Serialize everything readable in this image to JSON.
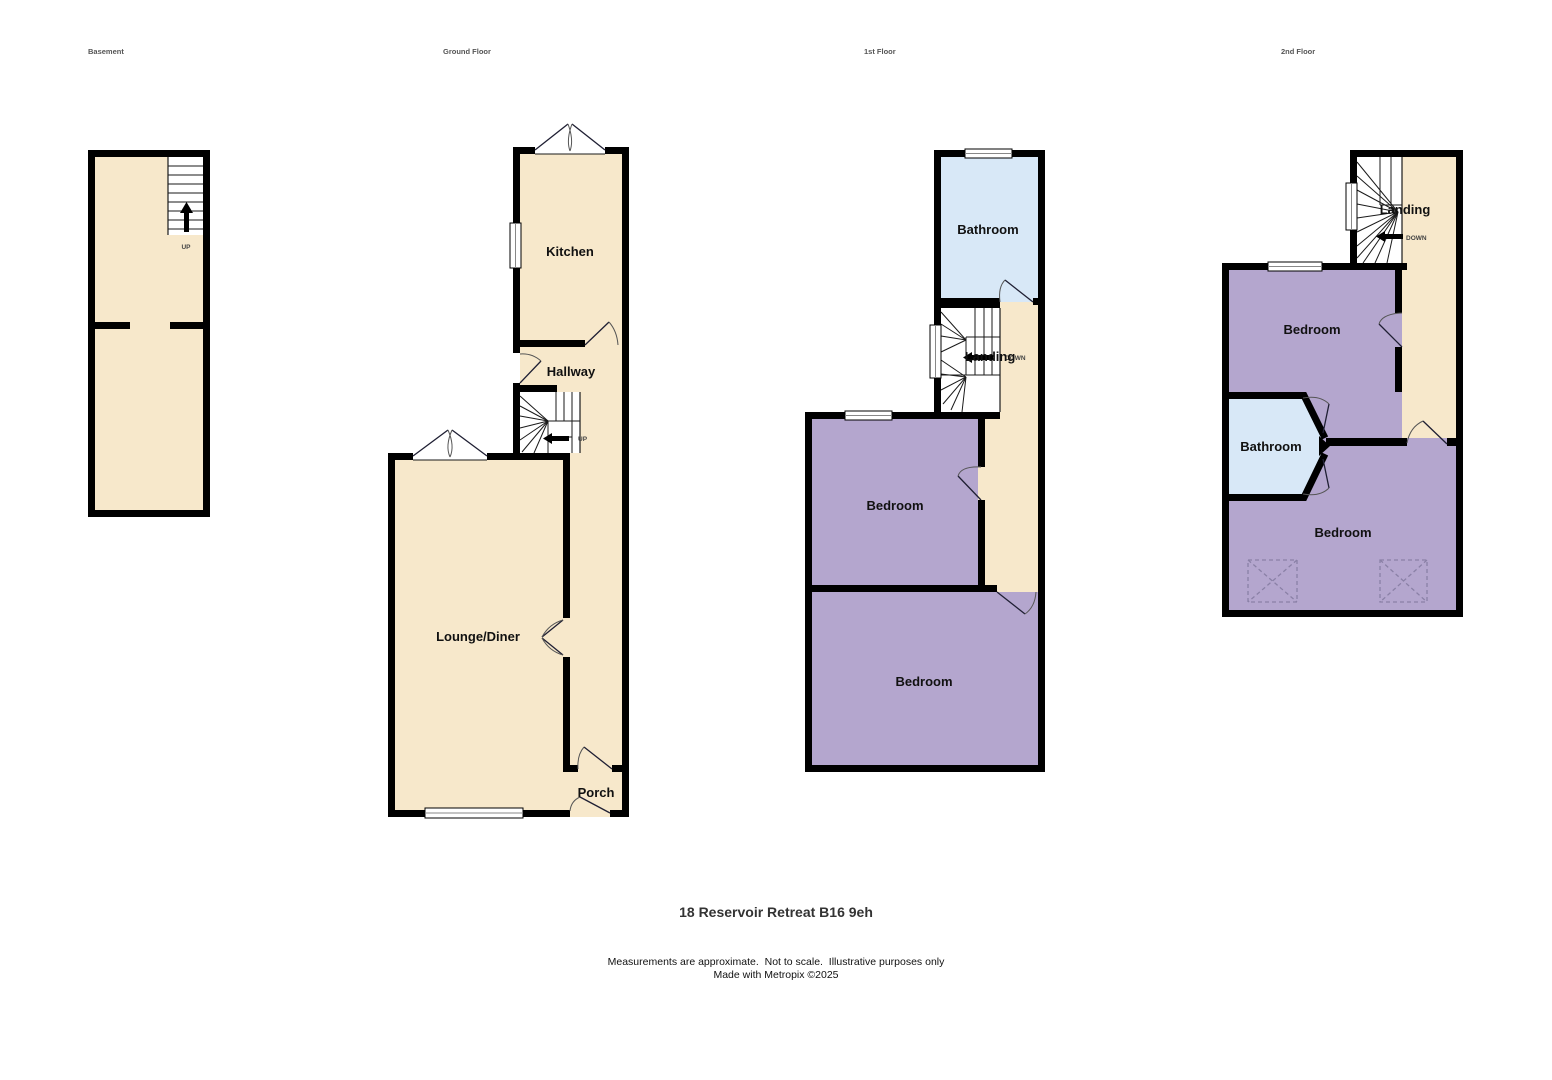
{
  "colors": {
    "cream": "#F7E8CB",
    "purple": "#B4A6CE",
    "blue": "#D8E8F7",
    "wall": "#000000",
    "arc": "#555555",
    "dashed_box": "#8A80A6",
    "label": "#111111",
    "floor_label": "#555555",
    "title_color": "#333333",
    "disclaimer": "#111111"
  },
  "floors": {
    "basement": {
      "label": "Basement",
      "stairs_direction": "UP"
    },
    "ground": {
      "label": "Ground Floor",
      "rooms": {
        "kitchen": "Kitchen",
        "hallway": "Hallway",
        "lounge": "Lounge/Diner",
        "porch": "Porch"
      },
      "stairs_direction": "UP"
    },
    "first": {
      "label": "1st Floor",
      "rooms": {
        "bathroom": "Bathroom",
        "landing": "Landing",
        "bedroom_front": "Bedroom",
        "bedroom_back": "Bedroom"
      },
      "stairs_direction": "DOWN"
    },
    "second": {
      "label": "2nd Floor",
      "rooms": {
        "landing": "Landing",
        "bedroom_front": "Bedroom",
        "bathroom": "Bathroom",
        "bedroom_back": "Bedroom"
      },
      "stairs_direction": "DOWN"
    }
  },
  "footer": {
    "title": "18 Reservoir Retreat B16 9eh",
    "disclaimer_line1": "Measurements are approximate.  Not to scale.  Illustrative purposes only",
    "disclaimer_line2": "Made with Metropix ©2025"
  }
}
